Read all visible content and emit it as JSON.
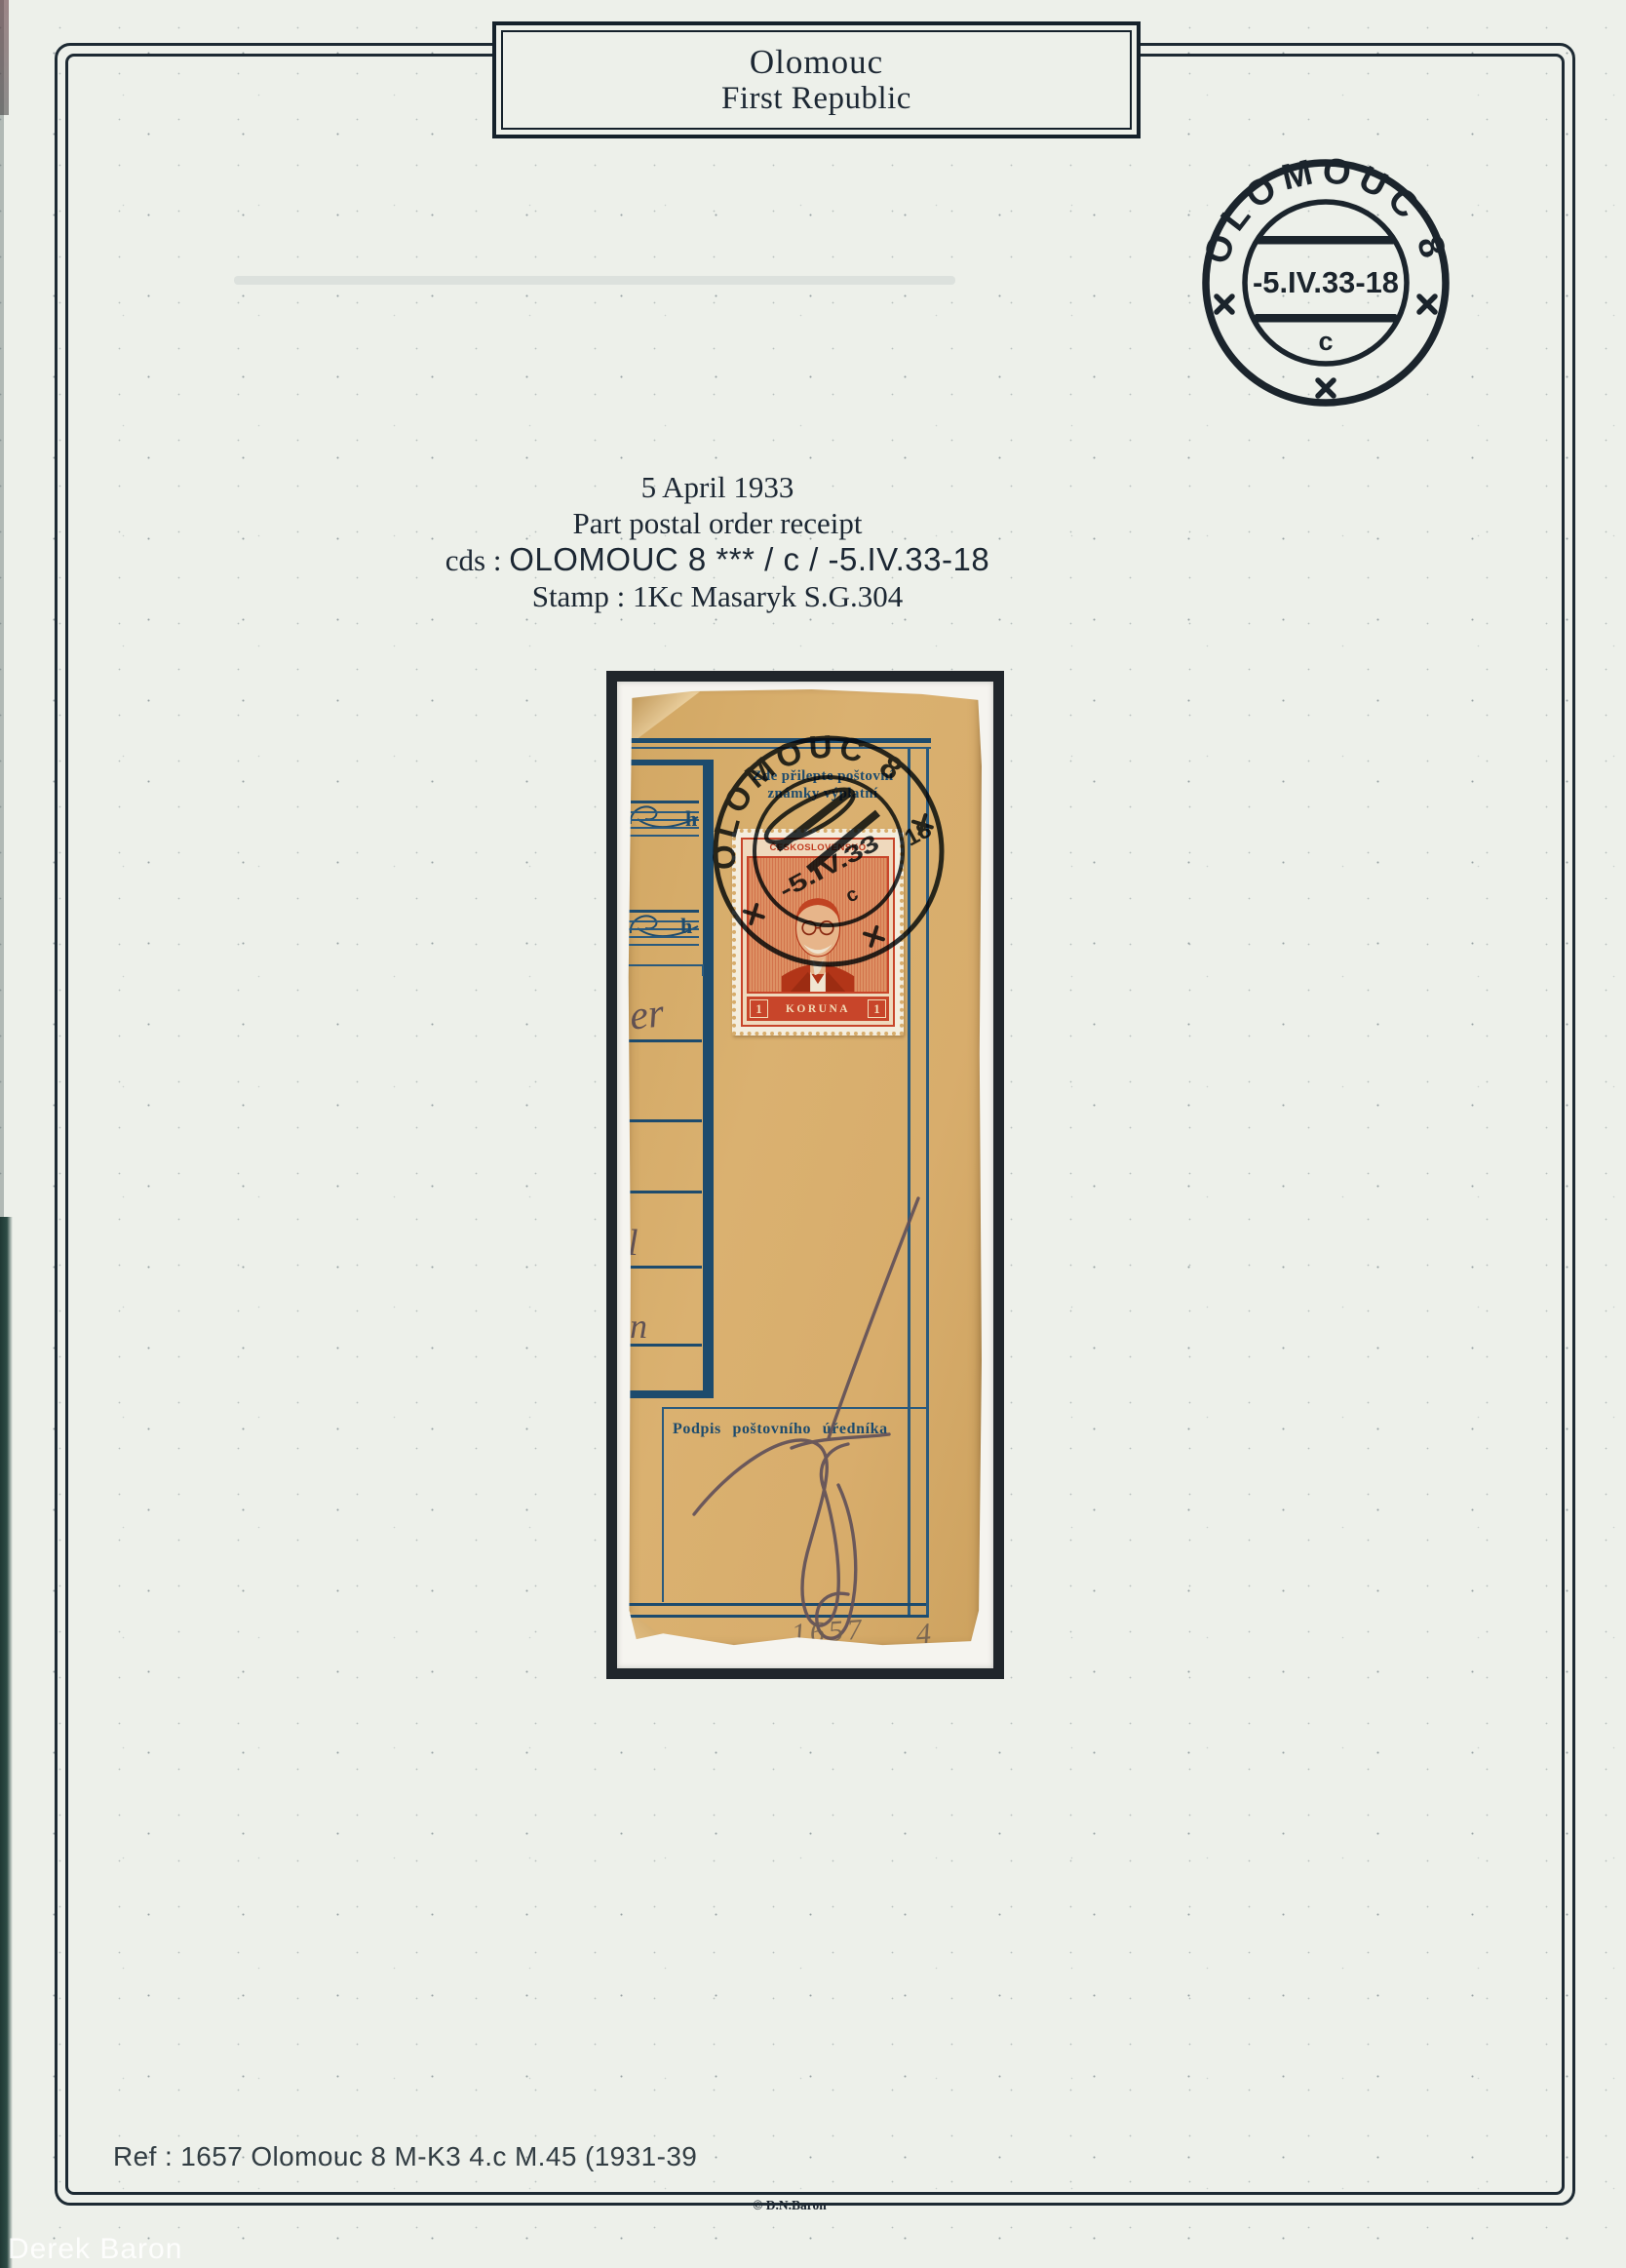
{
  "page": {
    "title": {
      "line1": "Olomouc",
      "line2": "First Republic"
    },
    "cds_illustration": {
      "town": "OLOMOUC 8",
      "date": "-5.IV.33-18",
      "index_letter": "c"
    },
    "description": {
      "date_line": "5 April 1933",
      "item_line": "Part postal order receipt",
      "cds_prefix": "cds : ",
      "cds_value": "OLOMOUC 8 *** / c / -5.IV.33-18",
      "stamp_line": "Stamp : 1Kc Masaryk S.G.304"
    },
    "footer": {
      "reference": "Ref : 1657 Olomouc 8 M-K3 4.c M.45 (1931-39",
      "copyright": "© D.N.Baron",
      "watermark": "Derek Baron"
    }
  },
  "receipt": {
    "affix_note": {
      "line1": "Zde přilepte poštovní",
      "line2": "známky výplatní"
    },
    "fee_fields": {
      "unit1": "h",
      "unit2": "h"
    },
    "signature_label": "Podpis poštovního úředníka",
    "pencil_annotations": {
      "number": "1657",
      "plate": "4"
    },
    "handwriting": {
      "fragment1": "er",
      "fragment2": "l",
      "fragment3": "n"
    },
    "postmark": {
      "town": "OLOMOUC 8",
      "date": "-5.IV.33",
      "hour": "18",
      "index_letter": "c"
    },
    "stamp": {
      "country": "ČESKOSLOVENSKO",
      "value_left": "1",
      "currency": "KORUNA",
      "value_right": "1"
    }
  },
  "colors": {
    "page_background": "#edf0ea",
    "ink_black": "#1b242c",
    "print_blue": "#1d4b6d",
    "paper_tan": "#d8ad6c",
    "stamp_red": "#c8452a",
    "pencil_gray": "#65555e"
  }
}
